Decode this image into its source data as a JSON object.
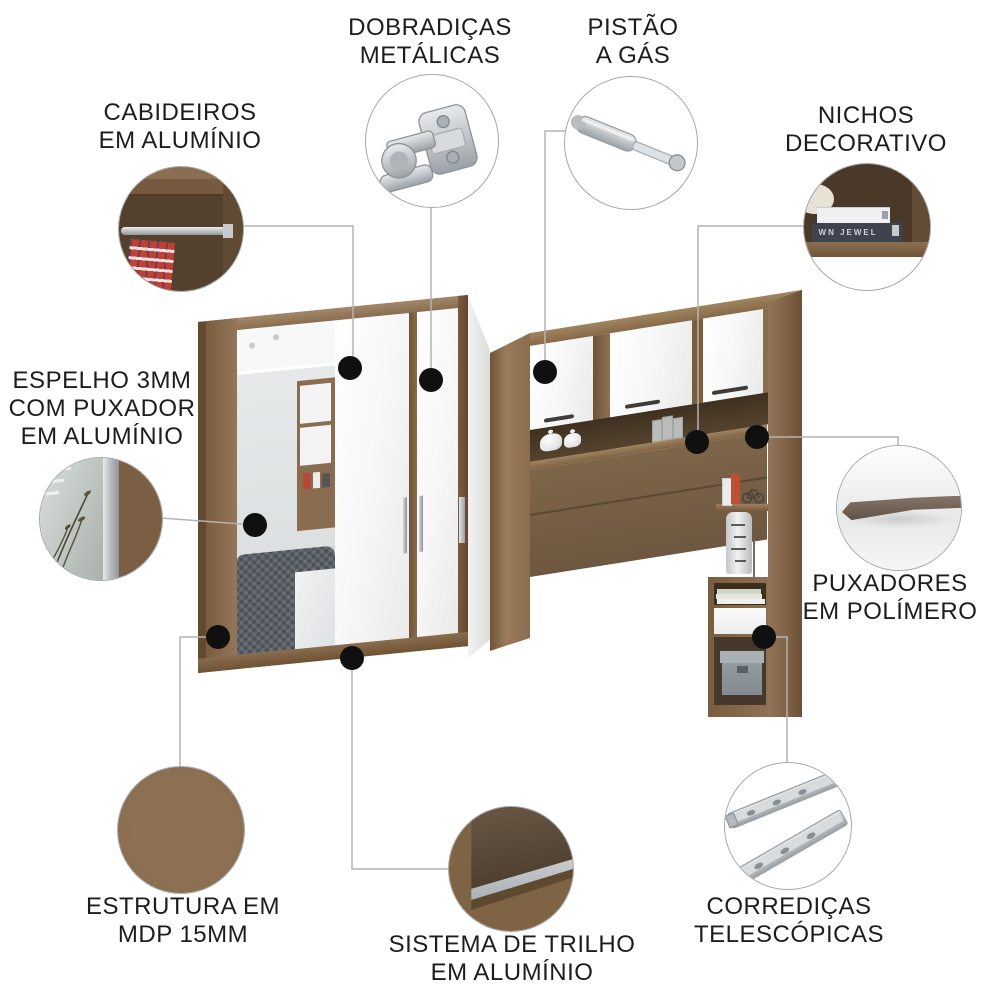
{
  "callouts": {
    "dobradicas": {
      "line1": "DOBRADIÇAS",
      "line2": "METÁLICAS",
      "image": "metal-hinge"
    },
    "pistao": {
      "line1": "PISTÃO",
      "line2": "A GÁS",
      "image": "gas-piston"
    },
    "cabideiros": {
      "line1": "CABIDEIROS",
      "line2": "EM ALUMÍNIO",
      "image": "aluminum-hanging-rod"
    },
    "nichos": {
      "line1": "NICHOS",
      "line2": "DECORATIVO",
      "image": "decorative-niche-books"
    },
    "espelho": {
      "line1": "ESPELHO 3MM",
      "line2": "COM PUXADOR",
      "line3": "EM ALUMÍNIO",
      "image": "mirror-aluminum-handle"
    },
    "puxadores": {
      "line1": "PUXADORES",
      "line2": "EM POLÍMERO",
      "image": "polymer-handle-profile"
    },
    "estrutura": {
      "line1": "ESTRUTURA EM",
      "line2": "MDP 15MM",
      "image": "mdp-wood-texture"
    },
    "sistema": {
      "line1": "SISTEMA DE TRILHO",
      "line2": "EM ALUMÍNIO",
      "image": "aluminum-track"
    },
    "corredicas": {
      "line1": "CORREDIÇAS",
      "line2": "TELESCÓPICAS",
      "image": "telescopic-slides"
    }
  },
  "details": {
    "book_spine": "WN JEWEL"
  },
  "colors": {
    "wood": "#8f7254",
    "wood_dark": "#6b5035",
    "white_door": "#f6f6f6",
    "mirror": "#dfe3e4",
    "metal": "#c3c7cb",
    "polymer_handle": "#6b5b4e",
    "text": "#1d1d1d",
    "connector_line": "#b3b3b3",
    "dot": "#101010"
  }
}
